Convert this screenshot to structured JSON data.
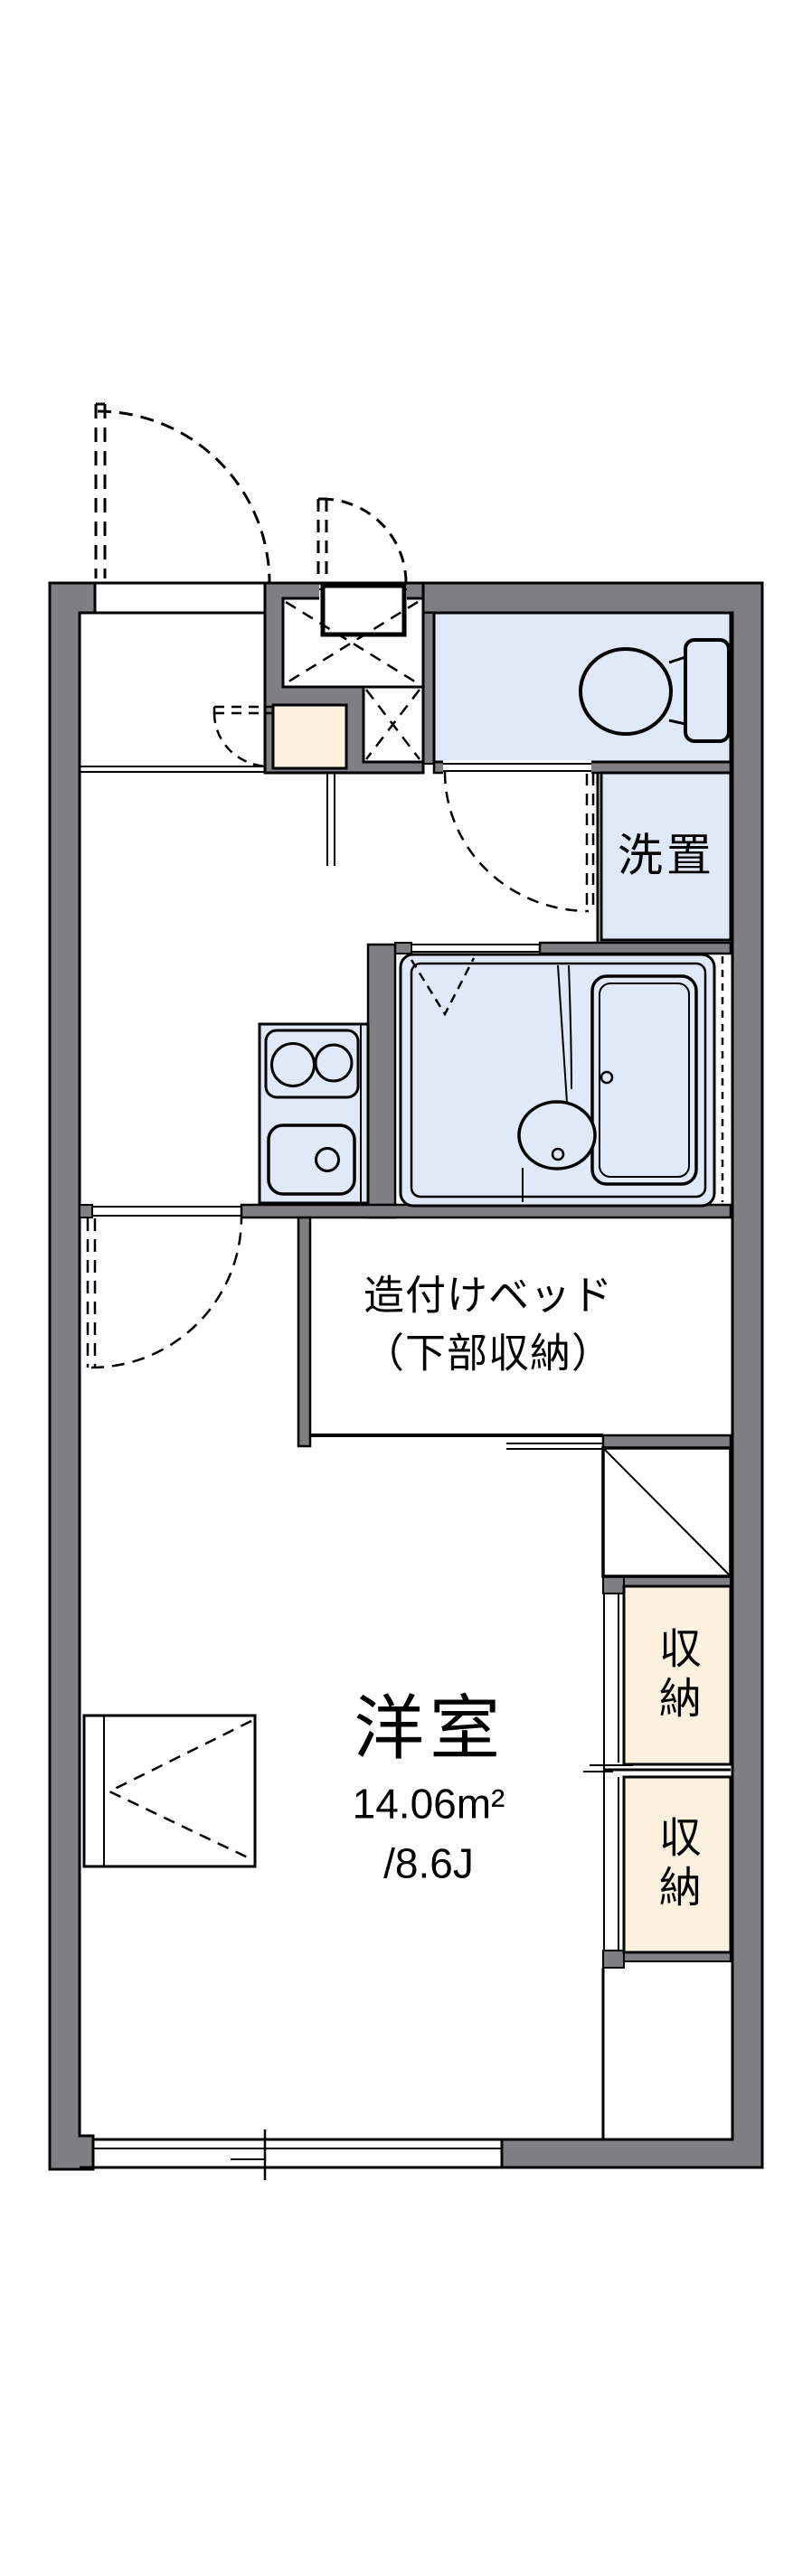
{
  "plan_title": "1K apartment floor plan",
  "rooms": {
    "western_room": {
      "name": "洋室",
      "area_m2": "14.06m²",
      "area_tatami": "/8.6J"
    },
    "built_in_bed": {
      "line1": "造付けベッド",
      "line2": "（下部収納）"
    },
    "laundry": {
      "label": "洗置"
    },
    "closets": [
      {
        "label": "収納"
      },
      {
        "label": "収納"
      }
    ]
  },
  "colors": {
    "wall": "#7f7f83",
    "water_area": "#dfe9f8",
    "storage": "#fbf1de",
    "outline": "#000000",
    "background": "#ffffff"
  }
}
